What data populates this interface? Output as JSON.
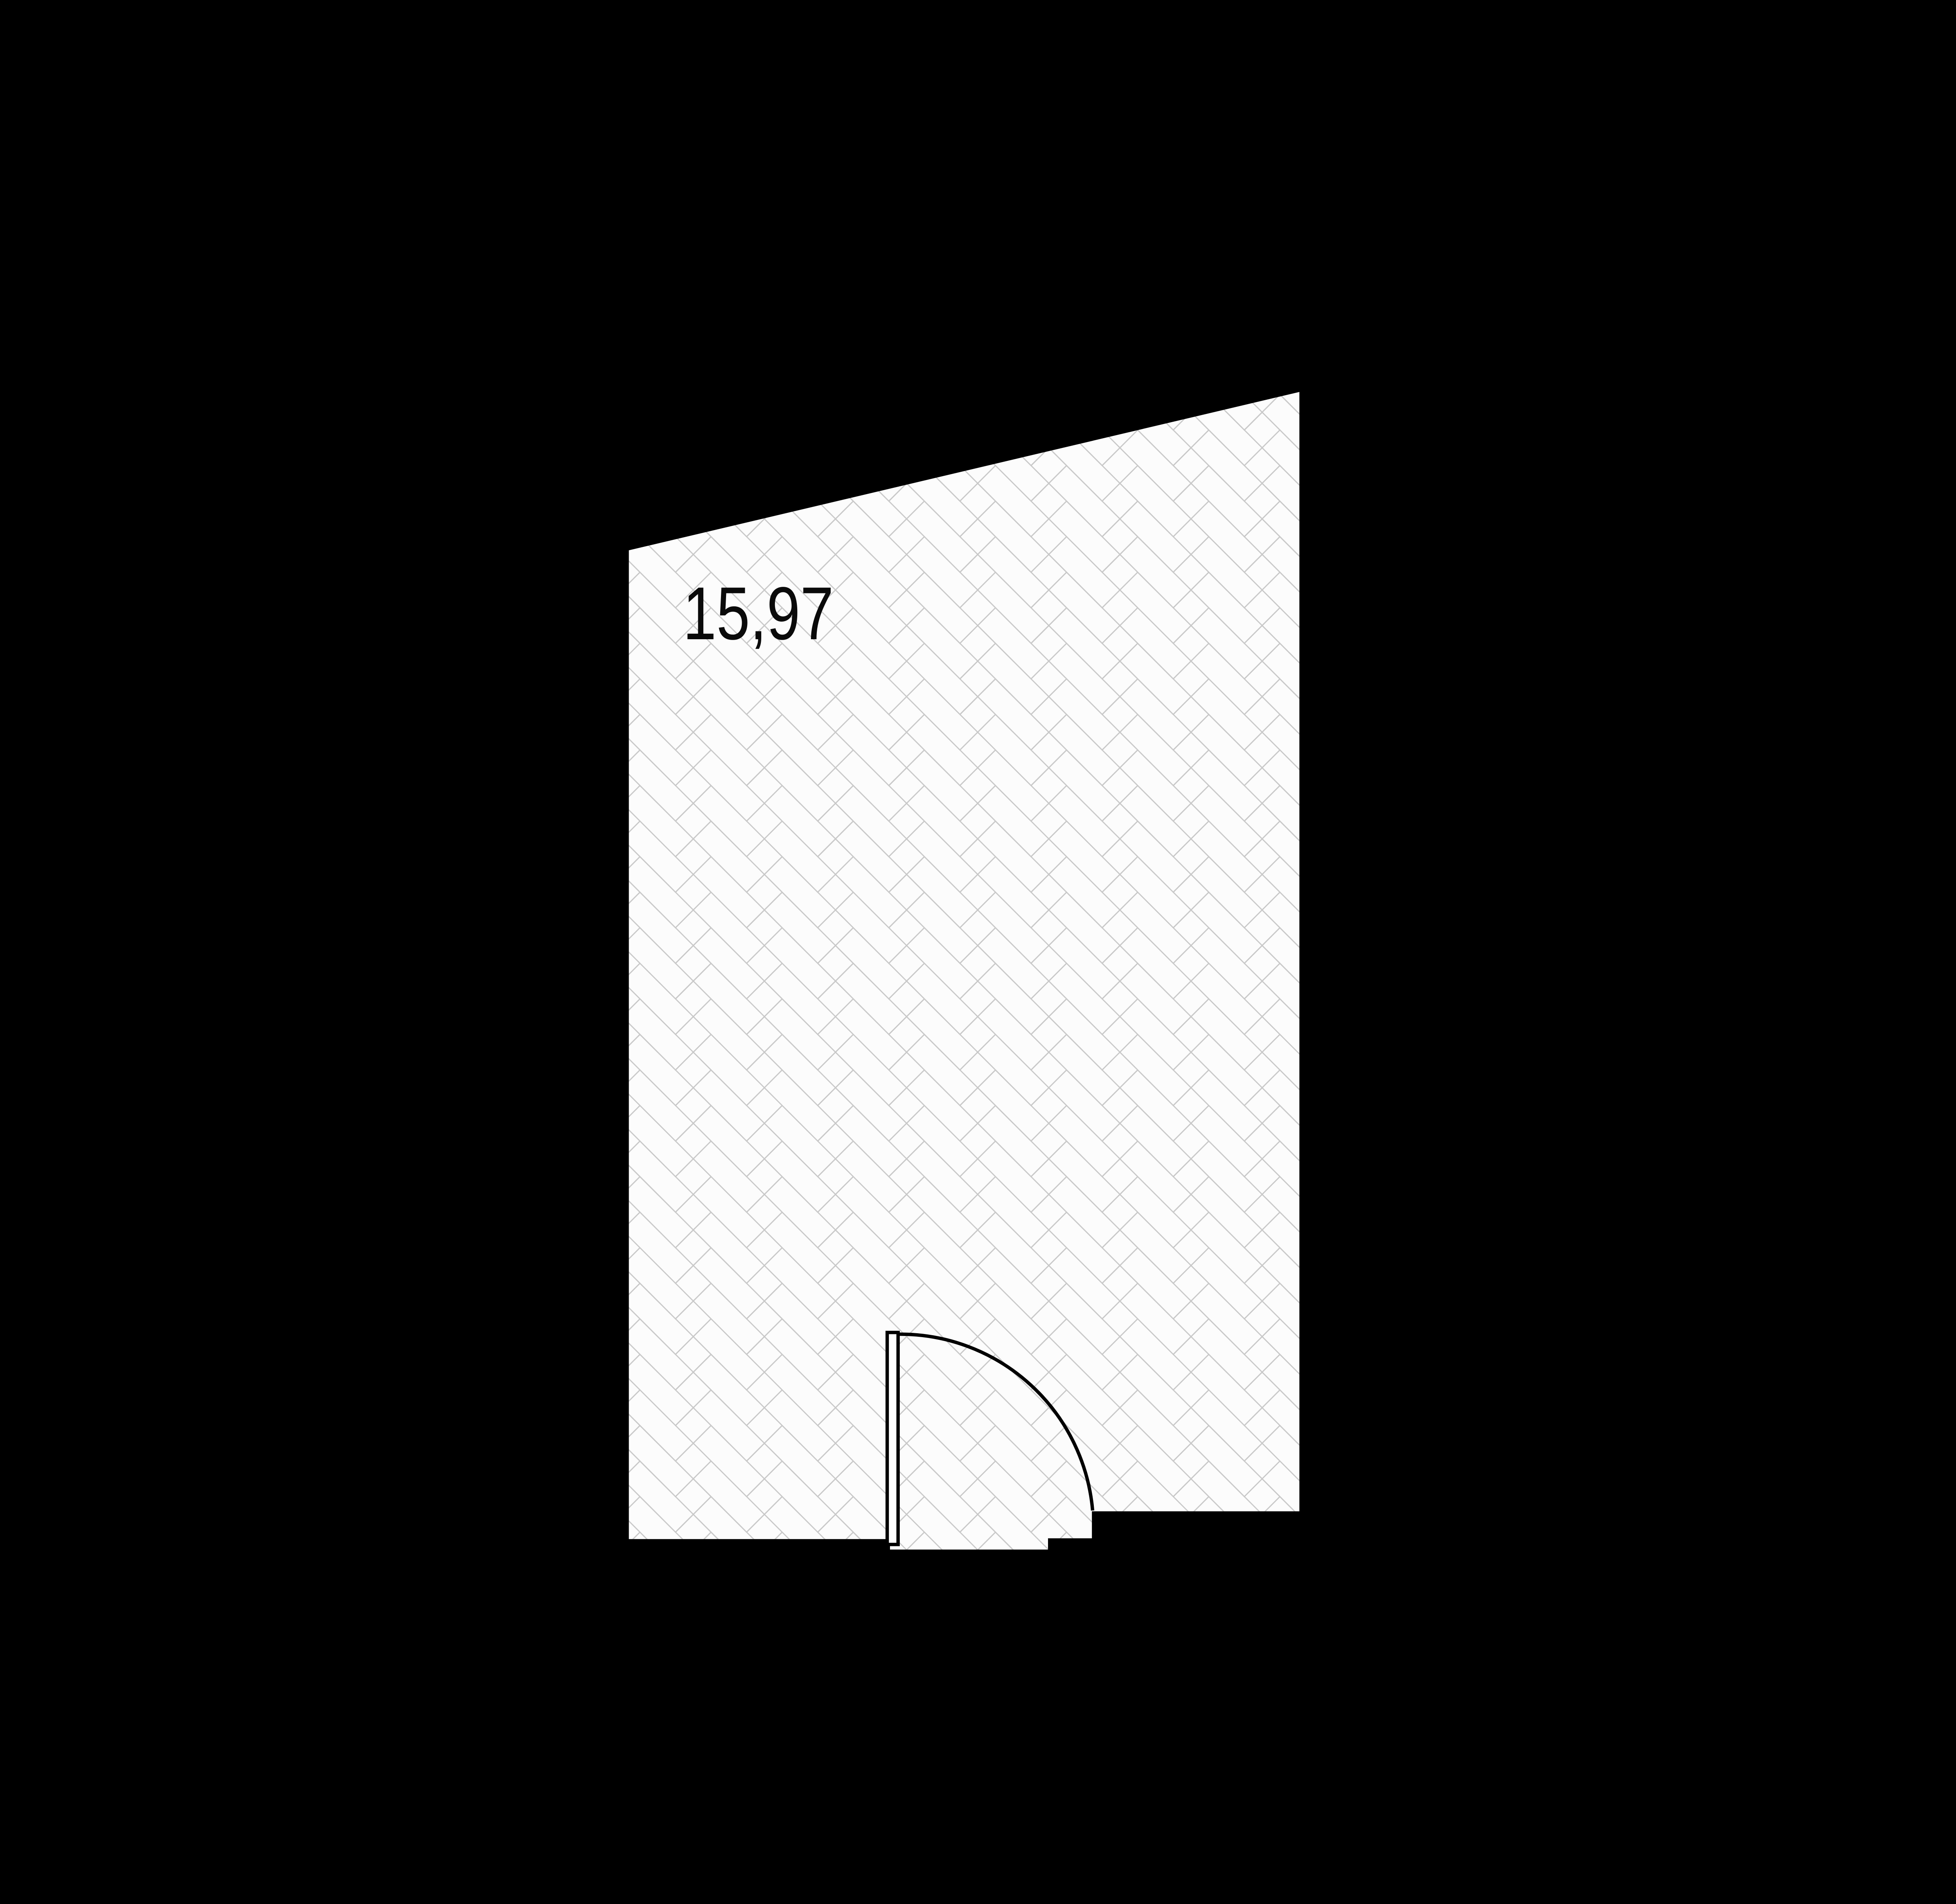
{
  "room": {
    "area_label": "15,97",
    "floor_pattern": "herringbone-parquet-45deg"
  },
  "door": {
    "type": "single-leaf-swing-door",
    "state": "open-90deg"
  },
  "colors": {
    "background": "#000000",
    "floor": "#fcfcfc",
    "pattern_line": "#c8c8c8",
    "outline": "#000000",
    "label_text": "#0a0a0a",
    "door_fill": "#ffffff"
  }
}
